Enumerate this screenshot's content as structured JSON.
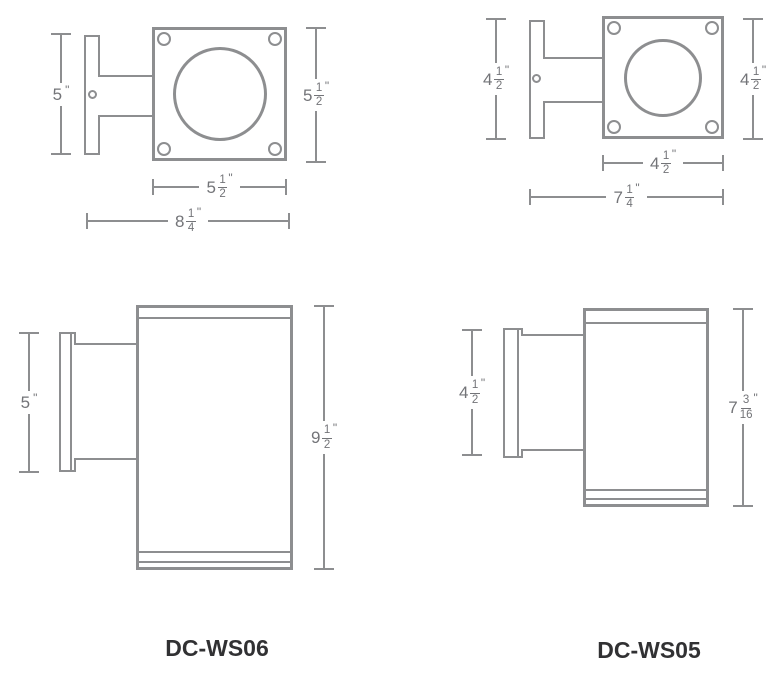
{
  "colors": {
    "background": "#ffffff",
    "line": "#8d8e90",
    "dimension_text": "#737478",
    "model_text": "#313133"
  },
  "models": {
    "ws06": "DC-WS06",
    "ws05": "DC-WS05"
  },
  "ws06_top": {
    "plate_height_dim": {
      "whole": "5",
      "num": "",
      "den": "",
      "unit": "\""
    },
    "face_height_dim": {
      "whole": "5",
      "num": "1",
      "den": "2",
      "unit": "\""
    },
    "face_width_dim": {
      "whole": "5",
      "num": "1",
      "den": "2",
      "unit": "\""
    },
    "overall_depth_dim": {
      "whole": "8",
      "num": "1",
      "den": "4",
      "unit": "\""
    }
  },
  "ws05_top": {
    "plate_height_dim": {
      "whole": "4",
      "num": "1",
      "den": "2",
      "unit": "\""
    },
    "face_height_dim": {
      "whole": "4",
      "num": "1",
      "den": "2",
      "unit": "\""
    },
    "face_width_dim": {
      "whole": "4",
      "num": "1",
      "den": "2",
      "unit": "\""
    },
    "overall_depth_dim": {
      "whole": "7",
      "num": "1",
      "den": "4",
      "unit": "\""
    }
  },
  "ws06_side": {
    "plate_height_dim": {
      "whole": "5",
      "num": "",
      "den": "",
      "unit": "\""
    },
    "body_height_dim": {
      "whole": "9",
      "num": "1",
      "den": "2",
      "unit": "\""
    }
  },
  "ws05_side": {
    "plate_height_dim": {
      "whole": "4",
      "num": "1",
      "den": "2",
      "unit": "\""
    },
    "body_height_dim": {
      "whole": "7",
      "num": "3",
      "den": "16",
      "unit": "\""
    }
  }
}
